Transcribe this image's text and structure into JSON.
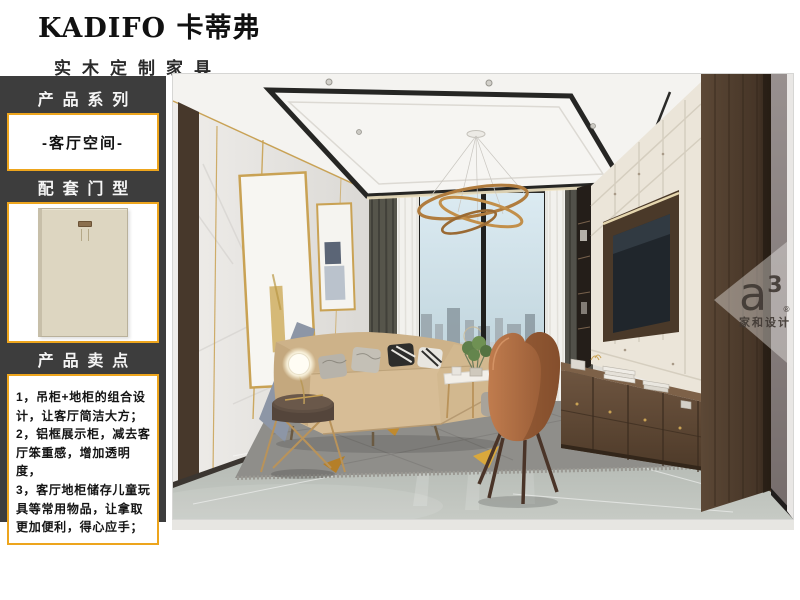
{
  "header": {
    "brand": "KADIFO 卡蒂弗",
    "tagline": "实木定制家具"
  },
  "sidebar": {
    "bg_color": "#3d3d3d",
    "accent_color": "#eda51d",
    "sections": {
      "series": {
        "label": "产品系列",
        "value": "-客厅空间-"
      },
      "door": {
        "label": "配套门型",
        "image": "door-panel-cream"
      },
      "selling": {
        "label": "产品卖点",
        "items": [
          "1，吊柜+地柜的组合设计，让客厅简洁大方；",
          "2，铝框展示柜，减去客厅笨重感，增加透明度，",
          "3，客厅地柜储存儿童玩具等常用物品，让拿取更加便利，得心应手；"
        ]
      }
    }
  },
  "photo": {
    "description": "living-room interior rendering",
    "watermark": {
      "logo": "a",
      "sup": "3",
      "reg": "®",
      "name": "家和设计"
    }
  }
}
